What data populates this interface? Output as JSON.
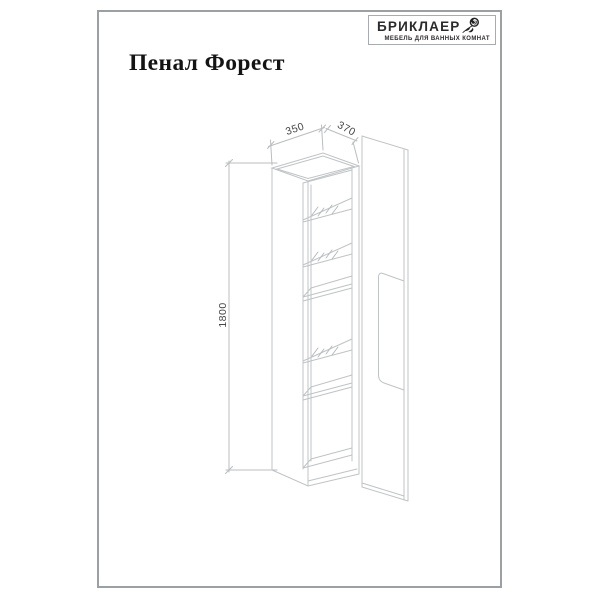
{
  "header": {
    "title": "Пенал Форест"
  },
  "logo": {
    "brand": "БРИКЛАЕР",
    "tagline": "МЕБЕЛЬ ДЛЯ ВАННЫХ КОМНАТ",
    "icon": "rose-icon"
  },
  "drawing": {
    "type": "furniture-technical-drawing",
    "subject": "tall bathroom cabinet (pencil case) with open door and shelves",
    "labels": {
      "width": "350",
      "depth": "370",
      "height": "1800"
    },
    "colors": {
      "line": "#bfc3c5",
      "dimension_text": "#454545",
      "frame_border": "#9aa0a3"
    }
  }
}
